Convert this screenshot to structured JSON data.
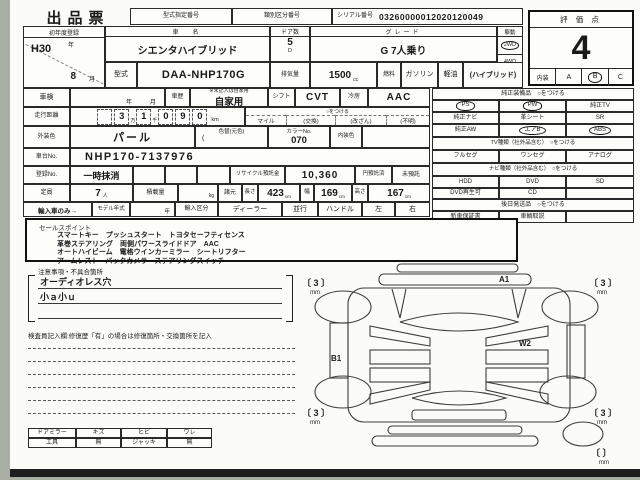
{
  "sheet": {
    "title": "出品票",
    "score_label": "評 価 点",
    "score": "4",
    "interior_label": "内装",
    "interior_a": "A",
    "interior_b": "B",
    "interior_c": "C"
  },
  "header": {
    "model_designation_label": "型式指定番号",
    "classification_label": "類別区分番号",
    "serial_label": "シリアル番号",
    "serial": "03260000012020120049"
  },
  "vehicle": {
    "first_reg_label": "初年度登録",
    "first_reg_year": "H30",
    "year_unit": "年",
    "first_reg_month": "8",
    "month_unit": "月",
    "name_label": "車　名",
    "name": "シエンタハイブリッド",
    "doors_label": "ドア数",
    "doors": "5",
    "doors_unit": "D",
    "grade_label": "グレード",
    "grade": "G 7人乗り",
    "drive_label": "駆動",
    "drive_2wd": "2WD",
    "drive_4wd": "4WD",
    "model_label": "型式",
    "model": "DAA-NHP170G",
    "disp_label": "排気量",
    "disp": "1500",
    "disp_unit": "cc",
    "fuel_label": "燃料",
    "fuel_gasoline": "ガソリン",
    "fuel_diesel": "軽油",
    "fuel_note": "(ハイブリッド)"
  },
  "inspection": {
    "shaken_label": "車検",
    "year_unit": "年",
    "month_unit": "月",
    "history_label": "車歴",
    "history_note": "※未記入は自家用",
    "history": "自家用",
    "shift_label": "シフト",
    "shift": "CVT",
    "ac_label": "冷房",
    "ac": "AAC"
  },
  "mileage": {
    "label": "走行距離",
    "d1": "",
    "d2": "3",
    "man": "万",
    "d3": "1",
    "sen": "千",
    "d4": "0",
    "d5": "9",
    "d6": "0",
    "unit": "km",
    "circle_note": "○をつける",
    "opt_mile": "マイル",
    "opt_exchange": "(交換)",
    "opt_tamper": "(改ざん)",
    "opt_unknown": "(不明)"
  },
  "color": {
    "exterior_label": "外装色",
    "exterior": "パール",
    "recolor_label": "色替(元色)",
    "paren": "(",
    "color_no_label": "カラーNo.",
    "color_no": "070",
    "interior_label": "内装色",
    "interior": ""
  },
  "chassis": {
    "label": "車台No.",
    "no": "NHP170-7137976"
  },
  "registration": {
    "label": "登録No.",
    "status": "一時抹消",
    "recycle_label": "リサイクル預託金",
    "recycle_amount": "10,360",
    "deposited": "円預託済",
    "not_deposited": "未預託"
  },
  "spec": {
    "capacity_label": "定員",
    "capacity": "7",
    "capacity_unit": "人",
    "load_label": "積載量",
    "load_unit": "kg",
    "dims_label": "諸元",
    "length_label": "長さ",
    "length": "423",
    "width_label": "幅",
    "width": "169",
    "height_label": "高さ",
    "height": "167",
    "cm": "cm"
  },
  "import": {
    "label": "輸入車のみ→",
    "model_year_label": "モデル年式",
    "year_unit": "年",
    "division_label": "輸入区分",
    "dealer": "ディーラー",
    "parallel": "並行",
    "handle_label": "ハンドル",
    "left": "左",
    "right": "右"
  },
  "equipment": {
    "genuine_header": "純正装備品　○をつける",
    "ps": "PS",
    "pw": "PW",
    "tv": "純正TV",
    "navi": "純正ナビ",
    "leather": "革シート",
    "sr": "SR",
    "aw": "純正AW",
    "airbag": "エアB",
    "abs": "ABS",
    "tv_header": "TV種類（社外品含む）　○をつける",
    "fullseg": "フルセグ",
    "oneseg": "ワンセグ",
    "analog": "アナログ",
    "navi_header": "ナビ種類（社外品含む）　○をつける",
    "hdd": "HDD",
    "dvd": "DVD",
    "sd": "SD",
    "dvd_play": "DVD再生可",
    "cd": "CD",
    "later_header": "後日発送品　○をつける",
    "warranty": "新車保証書",
    "manual": "車輌取説"
  },
  "sales": {
    "label": "セールスポイント",
    "line1": "スマートキー　プッシュスタート　トヨタセーフティセンス",
    "line2": "革巻ステアリング　両側パワースライドドア　AAC",
    "line3": "オートハイビーム　電格ウインカーミラー　シートリフター",
    "line4": "アームレスト　バックカメラ　ステアリングスイッチ"
  },
  "notes": {
    "label": "注意事項・不具合箇所",
    "line1": "オーディオレス穴",
    "line2": "小ａ小ｕ",
    "line3": ""
  },
  "inspector": {
    "label": "検査員記入欄:修復歴「有」の場合は修復箇所・交換箇所を記入"
  },
  "tools": {
    "mirror_label": "ドアミラー",
    "scratch": "キズ",
    "crack": "ヒビ",
    "split": "ワレ",
    "tool_label": "工具",
    "tool_value": "無",
    "jack_label": "ジャッキ",
    "jack_value": "無"
  },
  "diagram": {
    "mark_a": "A1",
    "mark_w": "W2",
    "mark_b": "B1",
    "tread_fl": "3",
    "tread_fr": "3",
    "tread_rl": "3",
    "tread_rr": "3",
    "tread_spare": "",
    "mm": "mm"
  }
}
